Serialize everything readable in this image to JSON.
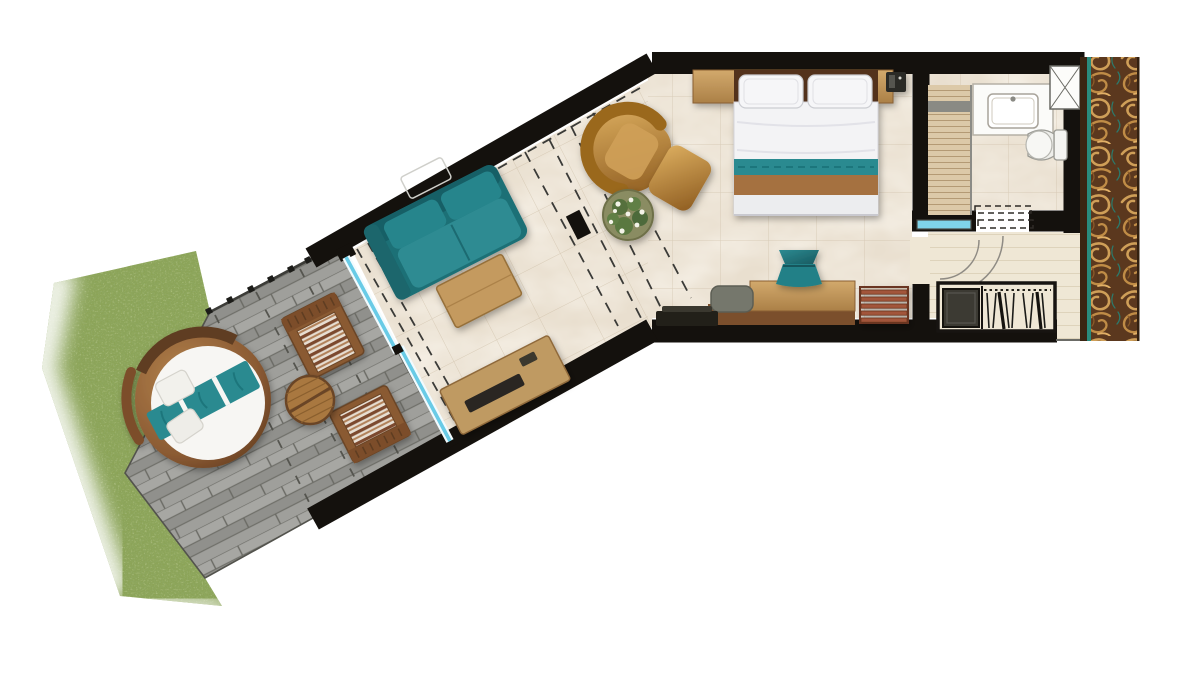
{
  "diagram": {
    "type": "floor-plan",
    "subject": "hotel-suite-top-view",
    "palette": {
      "wall": "#14110d",
      "marble_floor": "#e9dfcf",
      "entry_floor": "#efe7d5",
      "deck_base": "#9a9a96",
      "grass_base": "#8ba355",
      "sofa_teal": "#1f7076",
      "bed_runner_teal": "#2a8a90",
      "bed_throw_brown": "#a5713f",
      "glass_cyan": "#69cbe6",
      "wood_light": "#c9a266",
      "wood_dark": "#6e4426",
      "leather_tan": "#c2924a",
      "carpet_base": "#5b381e",
      "carpet_gold": "#cf9f58",
      "carpet_teal_line": "#2a8a7c",
      "lounge_stripe": "#7c4a2e"
    },
    "rooms": [
      {
        "name": "bedroom",
        "items": [
          "double-bed",
          "pillows",
          "headboard-shelf",
          "phone-clock",
          "armchair",
          "ottoman",
          "flower-plant",
          "desk",
          "desk-chair",
          "teal-stool",
          "tv-console",
          "luggage-rack"
        ]
      },
      {
        "name": "living-area",
        "items": [
          "teal-sofa",
          "coffee-table",
          "media-console",
          "sliding-glass-door"
        ]
      },
      {
        "name": "bathroom",
        "items": [
          "vanity-sink",
          "toilet",
          "walk-in-shower-floor",
          "shower-shaft",
          "glass-partition",
          "sliding-door"
        ]
      },
      {
        "name": "entry-hall",
        "items": [
          "wardrobe-hangers",
          "safe-minibar",
          "door-swing-arcs",
          "glass-panel"
        ]
      },
      {
        "name": "terrace",
        "items": [
          "round-daybed",
          "lounge-chair-1",
          "lounge-chair-2",
          "round-side-table",
          "railing"
        ]
      },
      {
        "name": "corridor",
        "items": [
          "ornamental-carpet"
        ]
      },
      {
        "name": "garden",
        "items": [
          "grass-lawn"
        ]
      }
    ]
  }
}
